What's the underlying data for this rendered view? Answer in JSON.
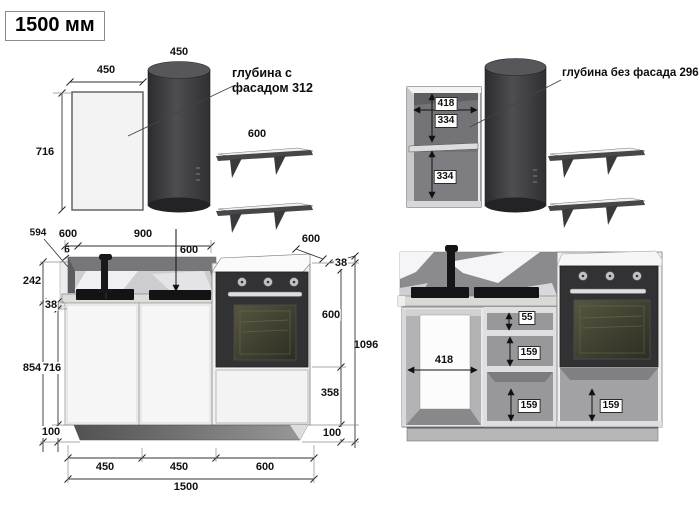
{
  "title": "1500 мм",
  "notes": {
    "with_facade": "глубина с фасадом 312",
    "without_facade": "глубина без фасада 296"
  },
  "upper_left": {
    "hood_width": "450",
    "panel_width": "450",
    "panel_height": "716",
    "shelf_length": "600"
  },
  "upper_right": {
    "cabinet_width": "418",
    "top_section": "334",
    "bottom_section": "334"
  },
  "lower_left": {
    "counter_end_depth": "594",
    "left_depth": "600",
    "span_to_hob": "900",
    "gap": "6",
    "hob_depth": "600",
    "oven_top_depth": "600",
    "top_counter_thickness": "38",
    "backsplash_height": "242",
    "counter_thickness": "38",
    "outer_height": "854",
    "cabinet_height": "716",
    "plinth_left": "100",
    "oven_niche": "600",
    "under_oven": "358",
    "plinth_right": "100",
    "total_height": "1096",
    "width_1": "450",
    "width_2": "450",
    "width_3": "600",
    "total_width": "1500"
  },
  "lower_right": {
    "inner_width": "418",
    "top_drawer": "55",
    "mid_drawer": "159",
    "bottom_drawer": "159",
    "oven_drawer": "159"
  }
}
